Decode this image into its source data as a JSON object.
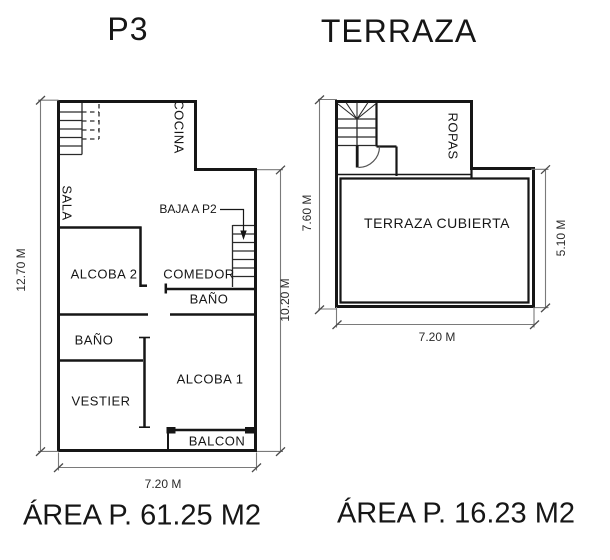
{
  "colors": {
    "background": "#ffffff",
    "wall": "#161616",
    "stair_line": "#2a2a2a",
    "dimension_line": "#7a7a7a",
    "dimension_text": "#2b2b2b"
  },
  "plans": {
    "p3": {
      "title": "P3",
      "area": "ÁREA P. 61.25 M2",
      "rooms": {
        "cocina": "COCINA",
        "sala": "SALA",
        "alcoba2": "ALCOBA 2",
        "comedor": "COMEDOR",
        "bano_pasillo": "BAÑO",
        "bano_izq": "BAÑO",
        "vestier": "VESTIER",
        "alcoba1": "ALCOBA 1",
        "balcon": "BALCON"
      },
      "annotations": {
        "baja_a_p2": "BAJA A P2"
      },
      "dims": {
        "left_height": "12.70 M",
        "right_height": "10.20 M",
        "width": "7.20 M"
      }
    },
    "terraza": {
      "title": "TERRAZA",
      "area": "ÁREA P. 16.23 M2",
      "rooms": {
        "ropas": "ROPAS",
        "cubierta": "TERRAZA CUBIERTA"
      },
      "dims": {
        "left_height": "7.60 M",
        "right_height": "5.10 M",
        "width": "7.20 M"
      }
    }
  }
}
